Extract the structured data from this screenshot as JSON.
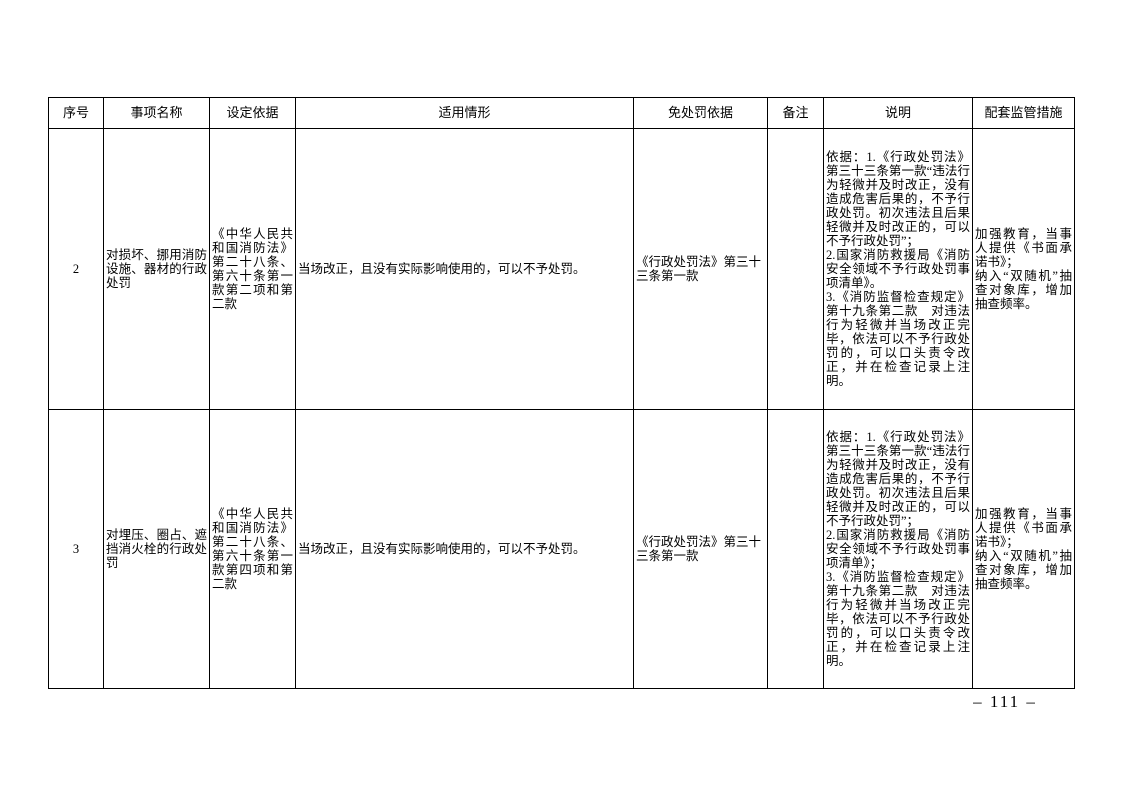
{
  "page": {
    "page_number": "– 111 –"
  },
  "table": {
    "headers": {
      "seq": "序号",
      "item_name": "事项名称",
      "basis": "设定依据",
      "situation": "适用情形",
      "exemption_basis": "免处罚依据",
      "remark": "备注",
      "explanation": "说明",
      "measures": "配套监管措施"
    },
    "rows": [
      {
        "seq": "2",
        "item_name": "对损坏、挪用消防设施、器材的行政处罚",
        "basis": "《中华人民共和国消防法》第二十八条、第六十条第一款第二项和第二款",
        "situation": "当场改正，且没有实际影响使用的，可以不予处罚。",
        "exemption_basis": "《行政处罚法》第三十三条第一款",
        "remark": "",
        "explanation": "依据：1.《行政处罚法》第三十三条第一款“违法行为轻微并及时改正，没有造成危害后果的，不予行政处罚。初次违法且后果轻微并及时改正的，可以不予行政处罚”；\n2.国家消防救援局《消防安全领域不予行政处罚事项清单》。\n3.《消防监督检查规定》第十九条第二款　对违法行为轻微并当场改正完毕，依法可以不予行政处罚的，可以口头责令改正，并在检查记录上注明。",
        "measures": "加强教育，当事人提供《书面承诺书》；\n纳入“双随机”抽查对象库，增加抽查频率。"
      },
      {
        "seq": "3",
        "item_name": "对埋压、圈占、遮挡消火栓的行政处罚",
        "basis": "《中华人民共和国消防法》第二十八条、第六十条第一款第四项和第二款",
        "situation": "当场改正，且没有实际影响使用的，可以不予处罚。",
        "exemption_basis": "《行政处罚法》第三十三条第一款",
        "remark": "",
        "explanation": "依据：1.《行政处罚法》第三十三条第一款“违法行为轻微并及时改正，没有造成危害后果的，不予行政处罚。初次违法且后果轻微并及时改正的，可以不予行政处罚”；\n2.国家消防救援局《消防安全领域不予行政处罚事项清单》；\n3.《消防监督检查规定》第十九条第二款　对违法行为轻微并当场改正完毕，依法可以不予行政处罚的，可以口头责令改正，并在检查记录上注明。",
        "measures": "加强教育，当事人提供《书面承诺书》；\n纳入“双随机”抽查对象库，增加抽查频率。"
      }
    ]
  }
}
